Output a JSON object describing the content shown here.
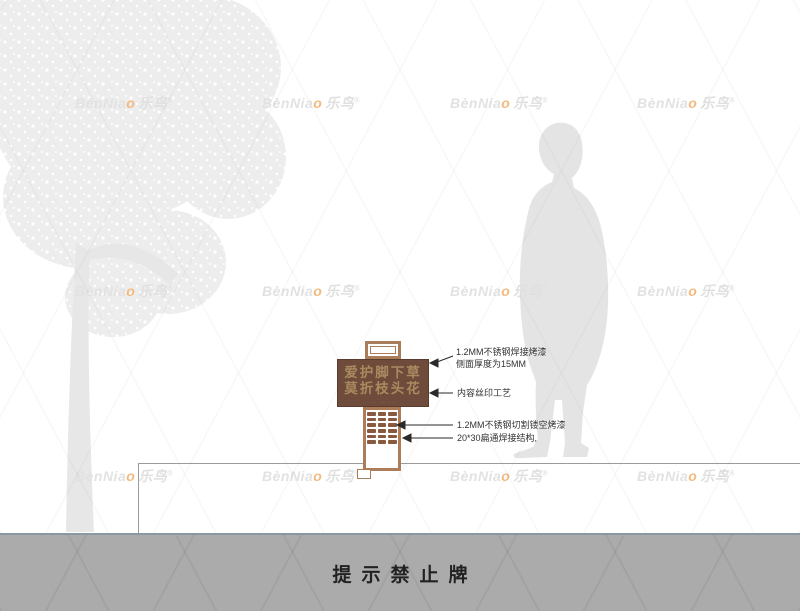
{
  "watermark": {
    "part_latin": "BènNia",
    "part_o": "o",
    "part_cn": "乐鸟",
    "reg": "®",
    "positions": [
      {
        "x": 75,
        "y": 93
      },
      {
        "x": 262,
        "y": 93
      },
      {
        "x": 450,
        "y": 93
      },
      {
        "x": 637,
        "y": 93
      },
      {
        "x": 75,
        "y": 281
      },
      {
        "x": 262,
        "y": 281
      },
      {
        "x": 450,
        "y": 281
      },
      {
        "x": 637,
        "y": 281
      },
      {
        "x": 75,
        "y": 466
      },
      {
        "x": 262,
        "y": 466
      },
      {
        "x": 450,
        "y": 466
      },
      {
        "x": 637,
        "y": 466
      }
    ]
  },
  "sign": {
    "board_line1": "爱护脚下草",
    "board_line2": "莫折枝头花",
    "board_small_text": "·· ·· ··",
    "annotations": [
      {
        "label": "1.2MM不锈钢焊接烤漆",
        "label2": "侧面厚度为15MM"
      },
      {
        "label": "内容丝印工艺"
      },
      {
        "label": "1.2MM不锈钢切割镂空烤漆"
      },
      {
        "label": "20*30扁通焊接结构,"
      }
    ]
  },
  "footer": {
    "title": "提示禁止牌"
  },
  "colors": {
    "board_brown": "#6e4b3b",
    "board_text": "#a98b60",
    "frame_brown": "#ad7c58",
    "lattice_brown": "#8a5a3e",
    "accent_orange": "#f4b97e",
    "watermark_gray": "#e2e2e2",
    "bar_gray": "#ababab",
    "bar_border": "#8b98a1",
    "annotation_text": "#333333"
  }
}
